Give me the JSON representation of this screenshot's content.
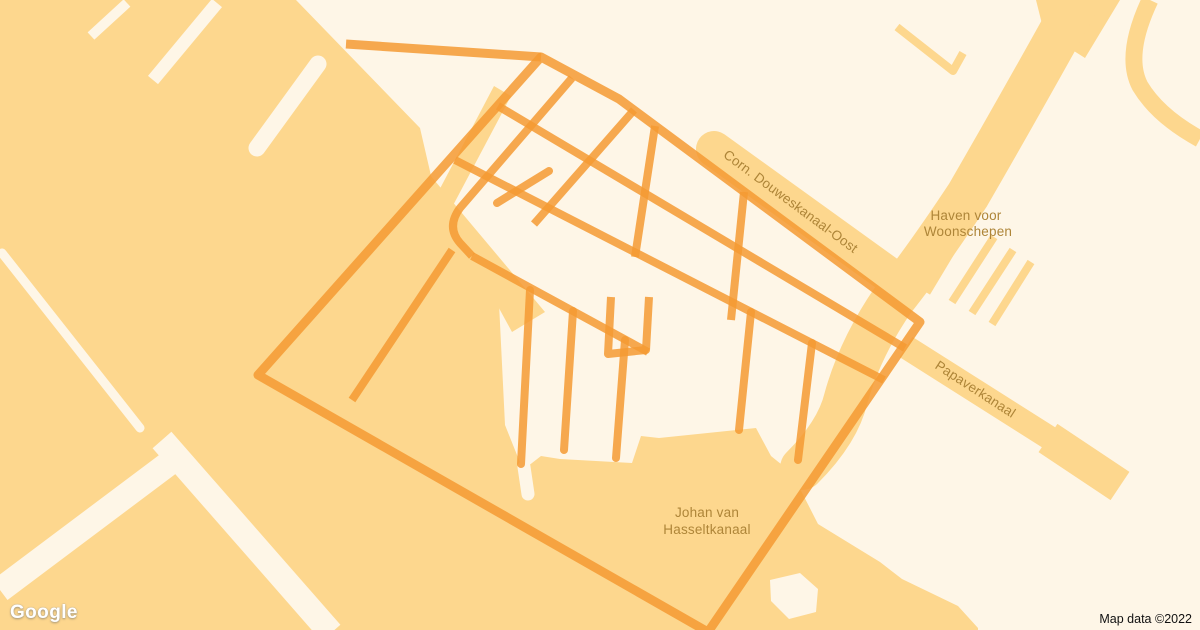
{
  "map": {
    "type": "static-map",
    "area": "NDSM / Amsterdam-Noord harbor area",
    "labels": {
      "corn_douweskanaal": "Corn. Douweskanaal-Oost",
      "haven_line1": "Haven voor",
      "haven_line2": "Woonschepen",
      "papaverkanaal": "Papaverkanaal",
      "johan_line1": "Johan van",
      "johan_line2": "Hasseltkanaal"
    },
    "colors": {
      "water": "#FDD78E",
      "land": "#FEF6E7",
      "road": "#F59A33",
      "label_text": "#AE8538",
      "attribution_text": "#111111",
      "logo_text": "#FFFFFF"
    },
    "provider": {
      "logo_text": "Google"
    },
    "attribution_text": "Map data ©2022"
  }
}
